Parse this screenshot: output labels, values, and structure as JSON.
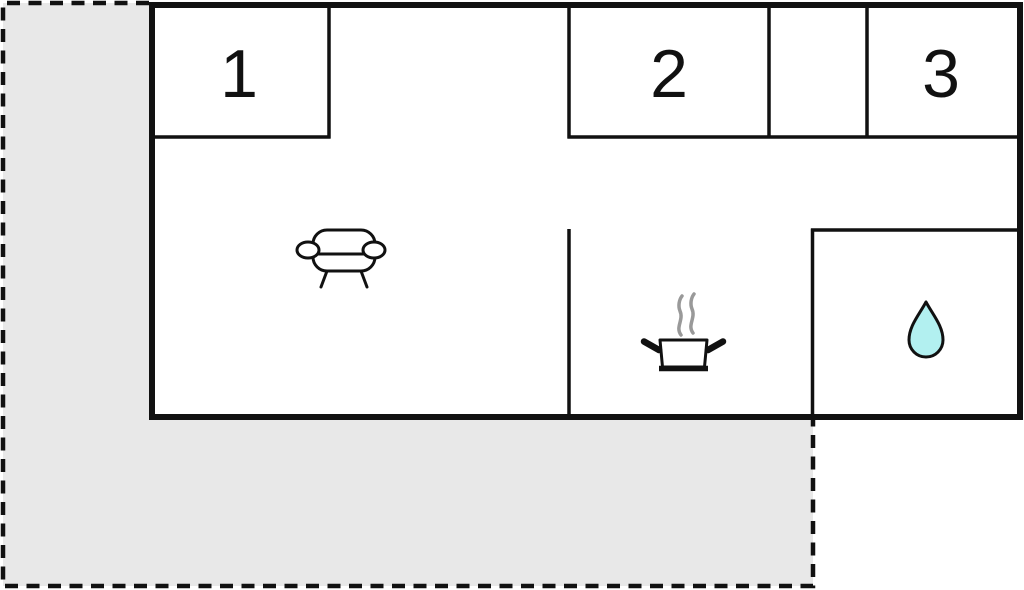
{
  "floorplan": {
    "description": "holiday-home floor plan with terrace",
    "colors": {
      "background": "#ffffff",
      "wall": "#111111",
      "terrace_fill": "#e8e8e8",
      "terrace_border": "#111111",
      "water_drop_fill": "#b2f0f0",
      "steam": "#999999",
      "label": "#111111",
      "room_fill": "#ffffff"
    },
    "rooms": [
      {
        "label": "1"
      },
      {
        "label": "2"
      },
      {
        "label": "3"
      }
    ],
    "icons": [
      {
        "name": "sofa-icon"
      },
      {
        "name": "cooking-pot-icon"
      },
      {
        "name": "steam-icon"
      },
      {
        "name": "water-drop-icon"
      }
    ]
  }
}
